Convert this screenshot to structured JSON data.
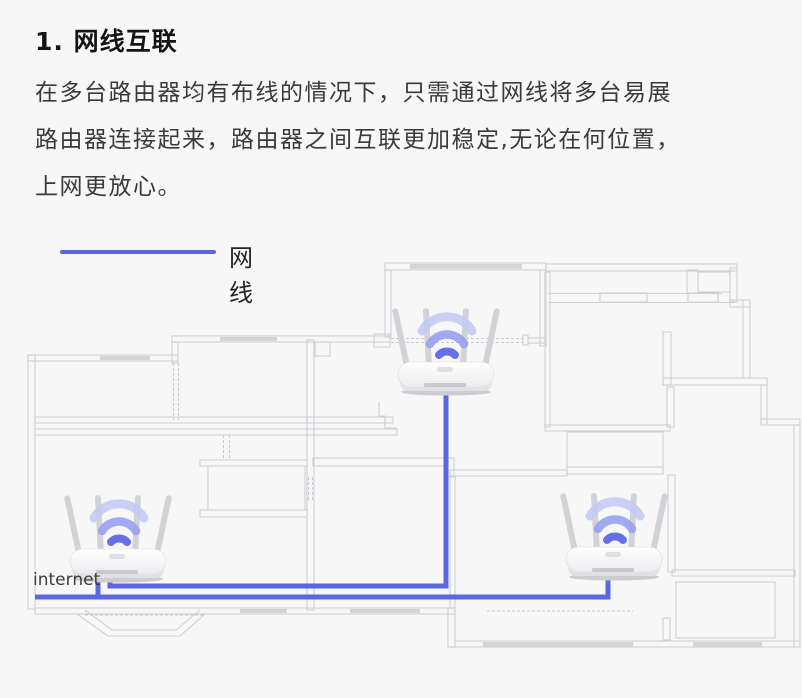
{
  "page": {
    "background": "#f7f7f8"
  },
  "heading": {
    "title": "1. 网线互联"
  },
  "paragraph": {
    "line1": "在多台路由器均有布线的情况下，只需通过网线将多台易展",
    "line2": "路由器连接起来，路由器之间互联更加稳定,无论在何位置，",
    "line3": "上网更放心。"
  },
  "legend": {
    "label": "网线",
    "line_color": "#5b66e2"
  },
  "diagram": {
    "internet_label": "internet",
    "router_count": 3,
    "routers": [
      {
        "name": "top-router"
      },
      {
        "name": "internet-router"
      },
      {
        "name": "bottom-right-router"
      }
    ],
    "colors": {
      "cable": "#5b66e2",
      "wall": "#cfd0d4",
      "window_fill": "#d4d4d7",
      "wifi_arc_dark": "#6570e6",
      "wifi_arc_mid": "#97a0f0",
      "wifi_arc_light": "#c2c8f5"
    }
  }
}
